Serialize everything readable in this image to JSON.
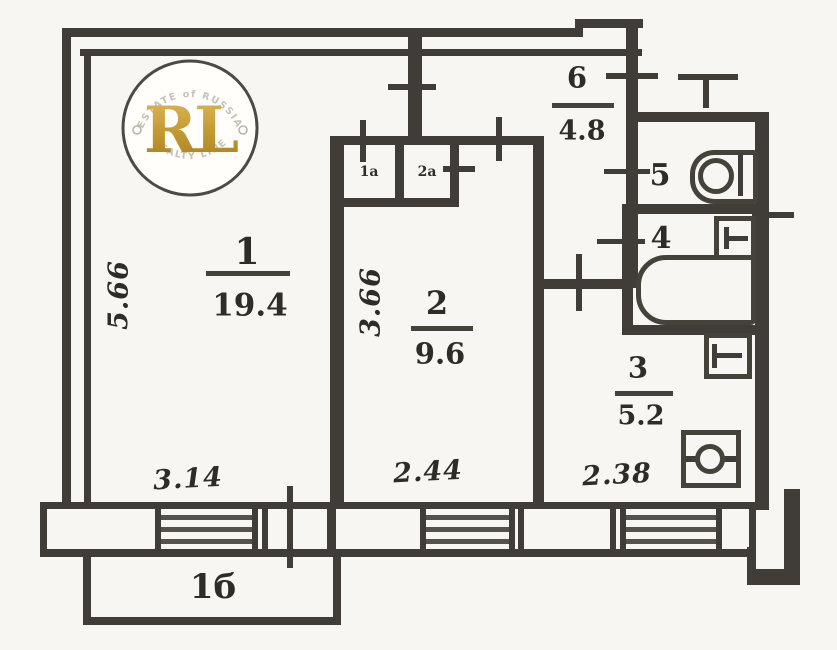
{
  "title": "Apartment floor plan",
  "logo": {
    "monogram": "RL",
    "arc_top": "ESTATE of RUSSIA",
    "arc_bottom": "REALTY LINE",
    "gold": "#c59a33"
  },
  "rooms": {
    "r1": {
      "number": "1",
      "area": "19.4"
    },
    "r2": {
      "number": "2",
      "area": "9.6"
    },
    "r3": {
      "number": "3",
      "area": "5.2"
    },
    "r4": {
      "number": "4"
    },
    "r5": {
      "number": "5"
    },
    "r6": {
      "number": "6",
      "area": "4.8"
    },
    "balcony": {
      "number": "1б"
    },
    "closet1": {
      "number": "1а"
    },
    "closet2": {
      "number": "2а"
    }
  },
  "dimensions": {
    "left_height": "5.66",
    "room2_height": "3.66",
    "room1_width": "3.14",
    "room2_width": "2.44",
    "kitchen_width": "2.38"
  },
  "icons": {
    "bathtub": "rounded-left rectangle",
    "sink": "circle in rounded cabinet",
    "stove": "square with circle and rod",
    "cabinet": "small square with tee mark"
  },
  "colors": {
    "wall": "#403c37",
    "paper": "#f7f6f2",
    "gold": "#c59a33"
  }
}
